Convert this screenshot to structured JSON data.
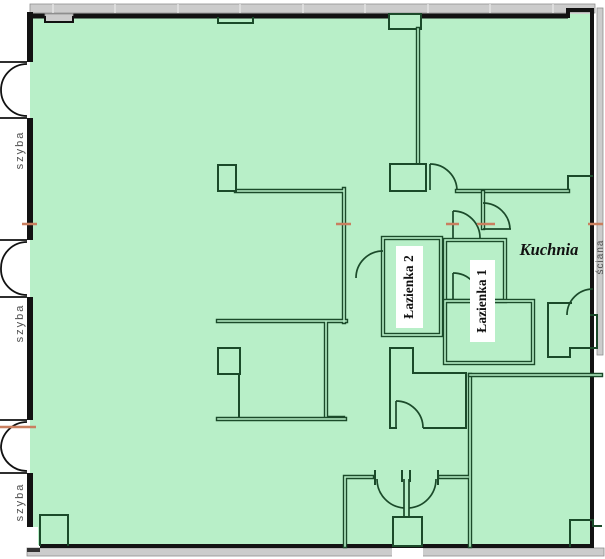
{
  "colors": {
    "floor": "#b8efc8",
    "wall": "#121212",
    "inner": "#1b4a2a",
    "gray": "#cccccc",
    "grayline": "#8f8f8f",
    "tick": "#c97f5f",
    "label": "#111111",
    "note": "#4f4f4f",
    "labelbg": "#ffffff"
  },
  "rooms": {
    "kitchen": {
      "label": "Kuchnia"
    },
    "bathroom_1": {
      "label": "Łazienka 1"
    },
    "bathroom_2": {
      "label": "Łazienka 2"
    }
  },
  "annotations": {
    "glass_panel": {
      "label": "szyba"
    },
    "wall_band": {
      "label": "ściana"
    }
  }
}
